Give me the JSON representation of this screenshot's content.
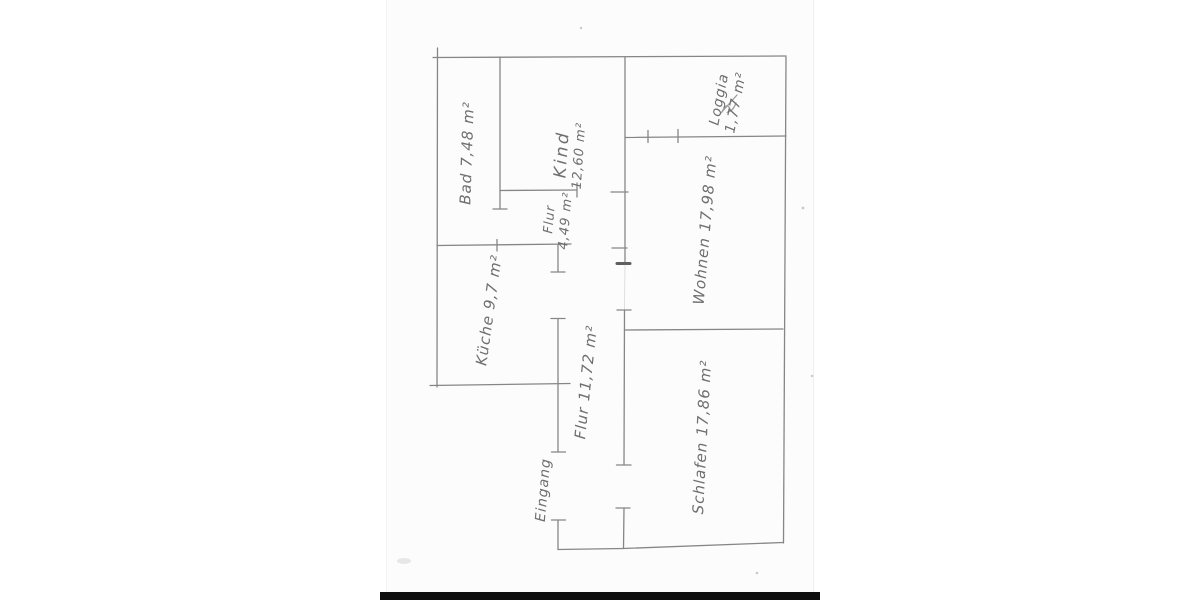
{
  "scan": {
    "paper_color": "#fcfcfc",
    "pencil_color": "#868686",
    "text_color": "#6f6f6f",
    "footer_bar_color": "#0e0e0e"
  },
  "rooms": {
    "bad": {
      "text": "Bad 7,48 m²"
    },
    "kind": {
      "text": "Kind",
      "text2": "12,60 m²"
    },
    "flur_klein": {
      "text": "Flur",
      "text2": "4,49 m²"
    },
    "kueche": {
      "text": "Küche 9,7 m²"
    },
    "loggia": {
      "text": "Loggia",
      "text2": "1,77 m²"
    },
    "wohnen": {
      "text": "Wohnen 17,98 m²"
    },
    "flur": {
      "text": "Flur 11,72 m²"
    },
    "schlafen": {
      "text": "Schlafen 17,86 m²"
    },
    "eingang": {
      "text": "Eingang"
    }
  }
}
